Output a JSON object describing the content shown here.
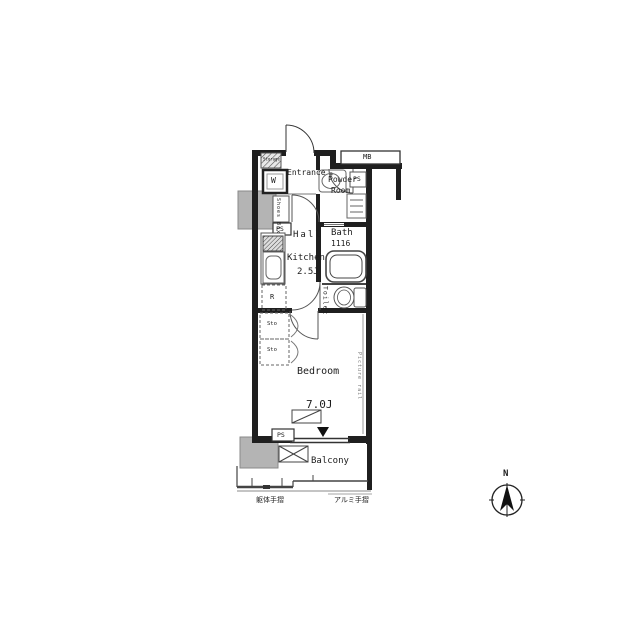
{
  "floorplan": {
    "rooms": {
      "entrance": "Entrance",
      "hall": "Hall",
      "kitchen": "Kitchen",
      "kitchen_size": "2.5J",
      "powder_line1": "Powder",
      "powder_line2": "Room",
      "bath": "Bath",
      "bath_size": "1116",
      "toilet": "Toilet",
      "bedroom": "Bedroom",
      "bedroom_size": "7.0J",
      "balcony": "Balcony"
    },
    "fixtures": {
      "washer": "W",
      "storage_small": "Storage",
      "shoes_box": "Shoes Box",
      "pipe_space": "PS",
      "meter_box": "MB",
      "fridge": "R",
      "closet": "Sto",
      "picture_rail": "Picture rail"
    },
    "annotations": {
      "rail_left": "躯体手摺",
      "rail_right": "アルミ手摺"
    },
    "colors": {
      "wall": "#1f1f1f",
      "fixture_line": "#666666",
      "gray_block": "#b4b4b4"
    }
  },
  "compass": {
    "north": "N"
  }
}
